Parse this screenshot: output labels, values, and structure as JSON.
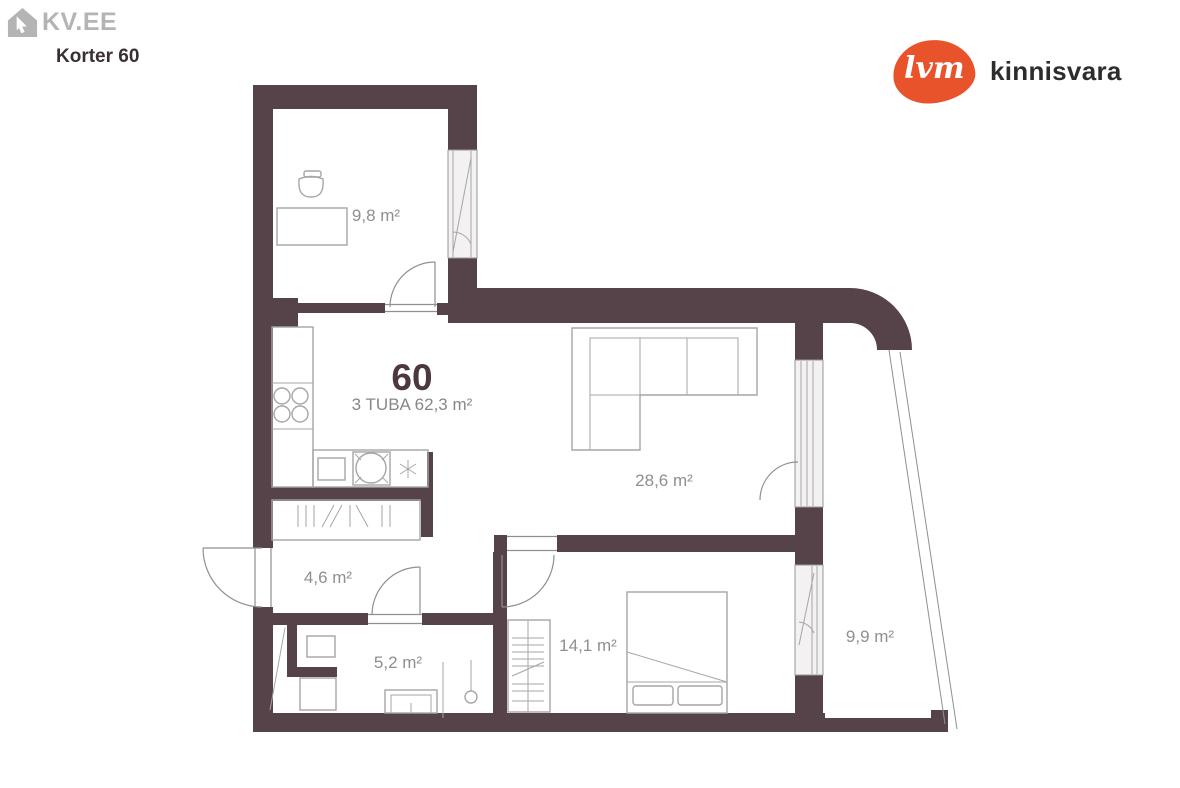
{
  "header": {
    "site_logo_text": "KV.EE",
    "listing_title": "Korter 60"
  },
  "agency": {
    "logo_text": "lvm",
    "name": "kinnisvara",
    "brand_color": "#e8532b"
  },
  "plan": {
    "apartment_number": "60",
    "apartment_summary": "3 TUBA 62,3 m²",
    "wall_color": "#564349",
    "rooms": [
      {
        "name": "office",
        "area": "9,8 m²"
      },
      {
        "name": "living-room",
        "area": "28,6 m²"
      },
      {
        "name": "hallway",
        "area": "4,6 m²"
      },
      {
        "name": "bathroom",
        "area": "5,2 m²"
      },
      {
        "name": "bedroom",
        "area": "14,1 m²"
      },
      {
        "name": "balcony",
        "area": "9,9 m²"
      }
    ]
  }
}
